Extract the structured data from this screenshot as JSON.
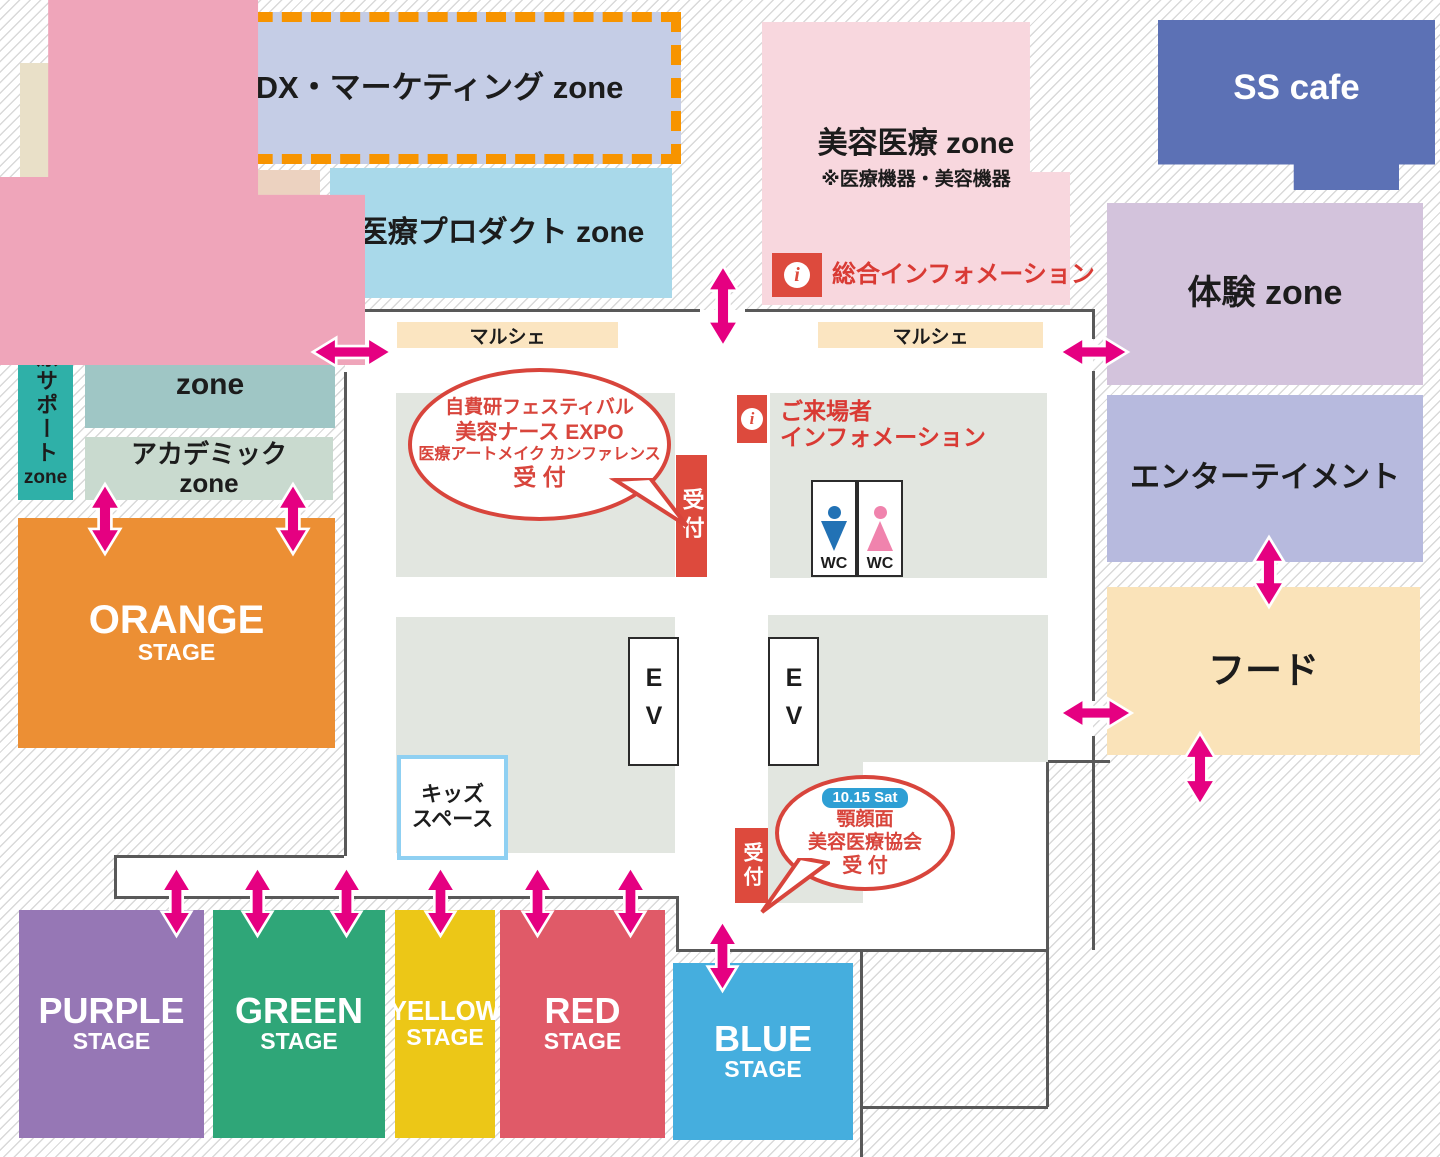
{
  "colors": {
    "arrow": "#e50081",
    "accent_red": "#dd4a3d",
    "wall": "#595959",
    "bubble_red": "#d8453c"
  },
  "zones": {
    "books": {
      "lines": [
        "書 籍",
        "zone"
      ]
    },
    "dx": {
      "label": "医療DX・マーケティング zone"
    },
    "ortho": {
      "lines": [
        "オーソ",
        "モレキュラー",
        "zone"
      ]
    },
    "dental": {
      "lines": [
        "デンタル",
        "zone"
      ]
    },
    "product": {
      "label": "医療プロダクト zone"
    },
    "beauty": {
      "title": "美容医療 zone",
      "note": "※医療機器・美容機器"
    },
    "sscafe": {
      "label": "SS cafe"
    },
    "taiken": {
      "label": "体験 zone"
    },
    "entertainment": {
      "label": "エンターテイメント"
    },
    "food": {
      "label": "フード"
    },
    "support": {
      "vertical": "医療サポート",
      "suffix": "zone"
    },
    "cosmetics": {
      "lines": [
        "コスメティクス",
        "zone"
      ]
    },
    "academic": {
      "lines": [
        "アカデミック",
        "zone"
      ]
    },
    "nurse_expo": {
      "label": "美容ナースEXPO",
      "logo_nurse": {
        "text": "美容ナース",
        "suffix": "EXPO"
      },
      "logo_artmake": {
        "mark": "CMA",
        "lines": [
          "医療アートメイク",
          "カンファレンス"
        ]
      }
    }
  },
  "stages": {
    "orange": {
      "name": "ORANGE",
      "sub": "STAGE"
    },
    "purple": {
      "name": "PURPLE",
      "sub": "STAGE"
    },
    "green": {
      "name": "GREEN",
      "sub": "STAGE"
    },
    "yellow": {
      "name": "YELLOW",
      "sub": "STAGE"
    },
    "red": {
      "name": "RED",
      "sub": "STAGE"
    },
    "blue": {
      "name": "BLUE",
      "sub": "STAGE"
    }
  },
  "facilities": {
    "marche_left": "マルシェ",
    "marche_right": "マルシェ",
    "reception_left": "受付",
    "reception_right": "受付",
    "ev_left": "EV",
    "ev_right": "EV",
    "wc_male": "WC",
    "wc_female": "WC",
    "kids": {
      "lines": [
        "キッズ",
        "スペース"
      ]
    }
  },
  "info": {
    "icon": "i",
    "general": "総合インフォメーション",
    "visitor_lines": [
      "ご来場者",
      "インフォメーション"
    ]
  },
  "bubbles": {
    "main_reception": {
      "lines": [
        "自費研フェスティバル",
        "美容ナース EXPO",
        "医療アートメイク カンファレンス",
        "受 付"
      ]
    },
    "gakuganmen": {
      "badge": "10.15 Sat",
      "lines": [
        "顎顔面",
        "美容医療協会",
        "受 付"
      ]
    }
  }
}
